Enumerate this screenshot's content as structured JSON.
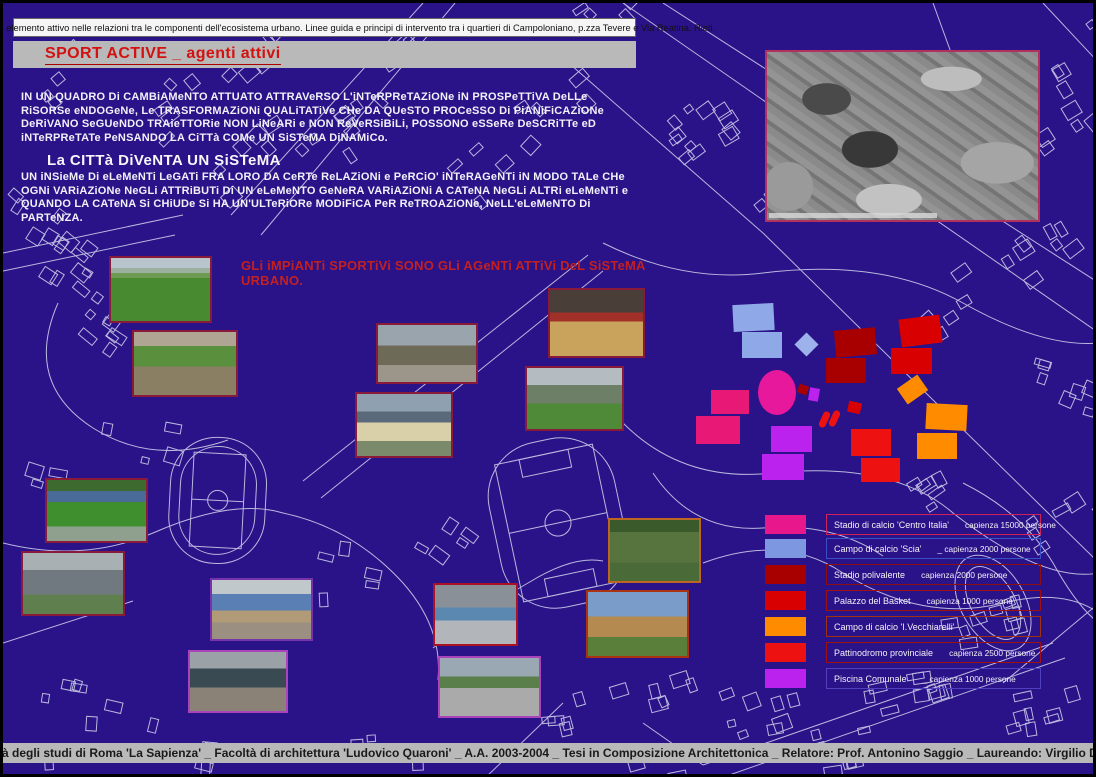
{
  "board": {
    "header_strip": "Lo SPORT come elemento attivo nelle relazioni tra le componenti dell'ecosistema urbano.  Linee guida e principi di intervento tra i quartieri di Campoloniano, p.zza Tevere e Via Reatina.  Rieti.",
    "title": "SPORT ACTIVE _  agenti attivi",
    "paragraph1": "IN UN QUADRO Di CAMBiAMeNTO ATTUATO ATTRAVeRSO L'iNTeRPReTAZiONe iN PROSPeTTiVA DeLLe RiSORSe eNDOGeNe, Le TRASFORMAZiONi QUALiTATiVe CHe DA QUeSTO PROCeSSO Di PiANiFiCAZiONe DeRiVANO SeGUeNDO TRAieTTORie NON LiNeARi e NON ReVeRSiBiLi, POSSONO eSSeRe DeSCRiTTe eD iNTeRPReTATe PeNSANDO LA CiTTà COMe UN SiSTeMA DiNAMiCo.",
    "subheading": "La CITTà DiVeNTA UN SiSTeMA",
    "paragraph2": "UN iNSieMe Di eLeMeNTi LeGATi FRA LORO DA CeRTe ReLAZiONi e PeRCiO' iNTeRAGeNTi iN MODO TALe CHe OGNi VARiAZiONe NeGLi ATTRiBUTi Di UN eLeMeNTO GeNeRA VARiAZiONi A CATeNA NeGLi ALTRi eLeMeNTi e QUANDO LA CATeNA Si CHiUDe Si HA UN'ULTeRiORe MODiFiCA PeR ReTROAZiONe, NeLL'eLeMeNTO Di PARTeNZA.",
    "statement": "GLi iMPiANTi SPORTiVi SONO GLi AGeNTi ATTiVi DeL SiSTeMA URBANO.",
    "footer": "Università degli studi di Roma 'La Sapienza'  _  Facoltà di architettura 'Ludovico Quaroni'  _  A.A. 2003-2004  _  Tesi in Composizione Architettonica  _  Relatore: Prof. Antonino Saggio  _  Laureando: Virgilio D'Annibale"
  },
  "colors": {
    "board_background": "#2a1288",
    "map_line": "#d4d5ee",
    "accent_red": "#d31111",
    "strip_gray": "#b9b9b9",
    "statement_red": "#c32020"
  },
  "legend": {
    "items": [
      {
        "name": "Stadio di calcio 'Centro Italia'",
        "capacity": "capienza 15000 persone",
        "swatch": "#e8188c",
        "border": "#cc2255",
        "y": 511
      },
      {
        "name": "Campo di calcio 'Scia'",
        "capacity": "_ capienza 2000 persone",
        "swatch": "#7d97e0",
        "border": "#3a50c8",
        "y": 535
      },
      {
        "name": "Stadio polivalente",
        "capacity": "capienza 2000 persone",
        "swatch": "#a80000",
        "border": "#8a0f0f",
        "y": 561
      },
      {
        "name": "Palazzo del Basket",
        "capacity": "capienza 1000 persone",
        "swatch": "#d80000",
        "border": "#a01010",
        "y": 587
      },
      {
        "name": "Campo di calcio 'I.Vecchiarelli'",
        "capacity": "",
        "swatch": "#ff8c00",
        "border": "#a03010",
        "y": 613
      },
      {
        "name": "Pattinodromo provinciale",
        "capacity": "capienza 2500 persone",
        "swatch": "#ee1111",
        "border": "#a01010",
        "y": 639
      },
      {
        "name": "Piscina Comunale",
        "capacity": "_ capienza 1000 persone",
        "swatch": "#bb22ee",
        "border": "#5040c0",
        "y": 665
      }
    ]
  },
  "photos": [
    {
      "name": "photo-campo-calcio-panorama",
      "kind": "field",
      "x": 106,
      "y": 253,
      "w": 103,
      "h": 67,
      "border": "#8a1a3a"
    },
    {
      "name": "photo-campo-vista-aerea",
      "kind": "aerialfield",
      "x": 129,
      "y": 327,
      "w": 106,
      "h": 67,
      "border": "#8a1a3a"
    },
    {
      "name": "photo-stadio-polivalente",
      "kind": "building",
      "x": 373,
      "y": 320,
      "w": 102,
      "h": 61,
      "border": "#8a1a3a"
    },
    {
      "name": "photo-palasport-interno",
      "kind": "gym",
      "x": 545,
      "y": 285,
      "w": 97,
      "h": 70,
      "border": "#8a1a3a"
    },
    {
      "name": "photo-palazzetto-colonnato",
      "kind": "colonnade",
      "x": 522,
      "y": 363,
      "w": 99,
      "h": 65,
      "border": "#8a1a3a"
    },
    {
      "name": "photo-edificio-scolastico",
      "kind": "school",
      "x": 352,
      "y": 389,
      "w": 98,
      "h": 66,
      "border": "#8a1a3a"
    },
    {
      "name": "photo-stadio-centro-italia",
      "kind": "stadium",
      "x": 42,
      "y": 475,
      "w": 103,
      "h": 65,
      "border": "#8a1a3a"
    },
    {
      "name": "photo-tribuna-cemento",
      "kind": "grandstand",
      "x": 18,
      "y": 548,
      "w": 104,
      "h": 65,
      "border": "#8a1a3a"
    },
    {
      "name": "photo-capannone-blu",
      "kind": "bluehall",
      "x": 207,
      "y": 575,
      "w": 103,
      "h": 63,
      "border": "#7733aa"
    },
    {
      "name": "photo-capannone-campo",
      "kind": "warehouse",
      "x": 185,
      "y": 647,
      "w": 100,
      "h": 63,
      "border": "#aa44bb"
    },
    {
      "name": "photo-pattinodromo-tribune",
      "kind": "walkway",
      "x": 430,
      "y": 580,
      "w": 85,
      "h": 63,
      "border": "#aa1122"
    },
    {
      "name": "photo-percorso-pavimentato",
      "kind": "path",
      "x": 435,
      "y": 653,
      "w": 103,
      "h": 62,
      "border": "#aa44bb"
    },
    {
      "name": "photo-campo-recintato",
      "kind": "fence",
      "x": 605,
      "y": 515,
      "w": 93,
      "h": 65,
      "border": "#bb6622"
    },
    {
      "name": "photo-chiosco-legno",
      "kind": "kiosk",
      "x": 583,
      "y": 587,
      "w": 103,
      "h": 68,
      "border": "#aa3311"
    }
  ],
  "markers": [
    {
      "shape": "rect",
      "color": "#8fa8e8",
      "x": 730,
      "y": 301,
      "w": 41,
      "h": 27,
      "rot": -3
    },
    {
      "shape": "rect",
      "color": "#8fa8e8",
      "x": 739,
      "y": 329,
      "w": 40,
      "h": 26,
      "rot": 0
    },
    {
      "shape": "rect",
      "color": "#9db2ea",
      "x": 795,
      "y": 333,
      "w": 17,
      "h": 17,
      "rot": 45
    },
    {
      "shape": "rect",
      "color": "#a80000",
      "x": 832,
      "y": 326,
      "w": 41,
      "h": 27,
      "rot": -5
    },
    {
      "shape": "rect",
      "color": "#a80000",
      "x": 823,
      "y": 355,
      "w": 40,
      "h": 25,
      "rot": 0
    },
    {
      "shape": "rect",
      "color": "#d80000",
      "x": 897,
      "y": 314,
      "w": 41,
      "h": 28,
      "rot": -7
    },
    {
      "shape": "rect",
      "color": "#d80000",
      "x": 888,
      "y": 345,
      "w": 41,
      "h": 26,
      "rot": 0
    },
    {
      "shape": "ellipse",
      "color": "#e8189c",
      "x": 755,
      "y": 367,
      "w": 38,
      "h": 45,
      "rot": 0
    },
    {
      "shape": "rect",
      "color": "#a80000",
      "x": 795,
      "y": 382,
      "w": 10,
      "h": 9,
      "rot": 20
    },
    {
      "shape": "rect",
      "color": "#bb22ee",
      "x": 806,
      "y": 385,
      "w": 10,
      "h": 13,
      "rot": 10
    },
    {
      "shape": "rect",
      "color": "#e81877",
      "x": 708,
      "y": 387,
      "w": 38,
      "h": 24,
      "rot": 0
    },
    {
      "shape": "rect",
      "color": "#e81877",
      "x": 693,
      "y": 413,
      "w": 44,
      "h": 28,
      "rot": 0
    },
    {
      "shape": "rect",
      "color": "#bb22ee",
      "x": 768,
      "y": 423,
      "w": 41,
      "h": 26,
      "rot": 0
    },
    {
      "shape": "rect",
      "color": "#bb22ee",
      "x": 759,
      "y": 451,
      "w": 42,
      "h": 26,
      "rot": 0
    },
    {
      "shape": "pill",
      "color": "#ee1111",
      "x": 818,
      "y": 408,
      "w": 7,
      "h": 17,
      "rot": 25
    },
    {
      "shape": "pill",
      "color": "#ee1111",
      "x": 828,
      "y": 407,
      "w": 7,
      "h": 17,
      "rot": 25
    },
    {
      "shape": "rect",
      "color": "#d80000",
      "x": 845,
      "y": 399,
      "w": 13,
      "h": 11,
      "rot": 12
    },
    {
      "shape": "rect",
      "color": "#ee1111",
      "x": 848,
      "y": 426,
      "w": 40,
      "h": 27,
      "rot": 0
    },
    {
      "shape": "rect",
      "color": "#ee1111",
      "x": 858,
      "y": 455,
      "w": 39,
      "h": 24,
      "rot": 0
    },
    {
      "shape": "rect",
      "color": "#ff8c00",
      "x": 897,
      "y": 377,
      "w": 25,
      "h": 19,
      "rot": -35
    },
    {
      "shape": "rect",
      "color": "#ff8c00",
      "x": 923,
      "y": 401,
      "w": 41,
      "h": 26,
      "rot": 3
    },
    {
      "shape": "rect",
      "color": "#ff8c00",
      "x": 914,
      "y": 430,
      "w": 40,
      "h": 26,
      "rot": 0
    }
  ]
}
